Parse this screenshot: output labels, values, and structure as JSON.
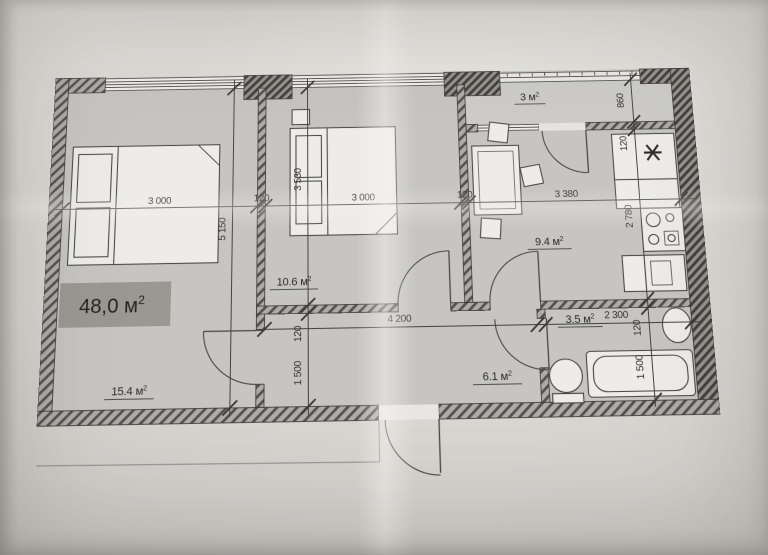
{
  "plan": {
    "total_area": {
      "label": "48,0 м",
      "sup": "2"
    },
    "rooms": {
      "living": {
        "label": "15.4 м",
        "sup": "2"
      },
      "bedroom": {
        "label": "10.6 м",
        "sup": "2"
      },
      "kitchen": {
        "label": "9.4 м",
        "sup": "2"
      },
      "balcony": {
        "label": "3 м",
        "sup": "2"
      },
      "bathroom": {
        "label": "3.5 м",
        "sup": "2"
      },
      "hallway": {
        "label": "6.1 м",
        "sup": "2"
      }
    },
    "dimensions": {
      "living_width": "3 000",
      "wall_a": "120",
      "bedroom_width": "3 000",
      "wall_b": "120",
      "kitchen_width": "3 380",
      "living_height": "5 150",
      "bedroom_height": "3 530",
      "hall_wall": "120",
      "hall_width": "1 500",
      "hall_length": "4 200",
      "balcony_depth": "860",
      "balcony_wall": "120",
      "kitchen_height": "2 780",
      "bath_width": "2 300",
      "bath_wall": "120",
      "bath_height": "1 500"
    },
    "icons": {
      "sink_marker": "✳"
    },
    "colors": {
      "paper": "#dbd9d4",
      "floor": "#c6c5c1",
      "wall_hatch_dark": "#4a4945",
      "ink": "#34332f",
      "highlight_box": "#8d8c87"
    }
  }
}
